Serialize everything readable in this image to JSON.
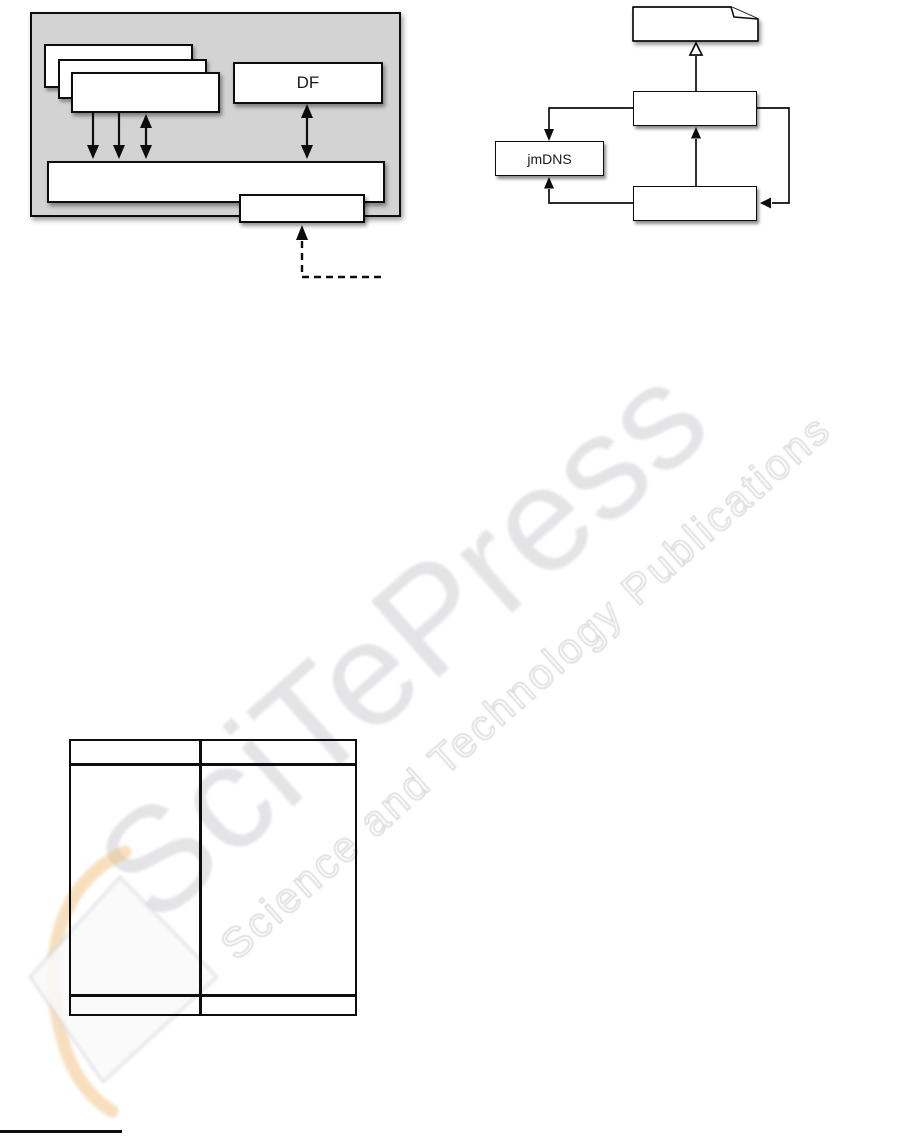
{
  "page": {
    "background": "#ffffff",
    "width_px": 915,
    "height_px": 1137
  },
  "figure_left": {
    "df_box_label": "DF",
    "container_fill_color": "#d3d3d3",
    "box_border_color": "#0d0d0d"
  },
  "figure_right": {
    "jmdns_box_label": "jmDNS"
  },
  "watermark": {
    "title": "SciTePress",
    "subtitle": "Science and Technology Publications",
    "title_color": "#e3e3e6",
    "subtitle_stroke_color": "#d7d7db",
    "logo_orange": "#f0bf7f"
  }
}
